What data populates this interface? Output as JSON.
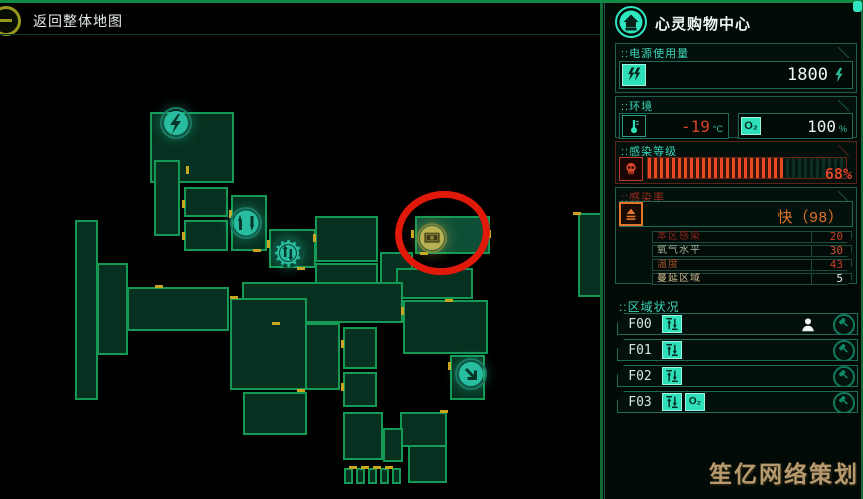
{
  "window": {
    "back_label": "返回整体地图"
  },
  "sidebar": {
    "section_prefix": "::",
    "title": "心灵购物中心",
    "power": {
      "label": "电源使用量",
      "value": "1800"
    },
    "environment": {
      "label": "环境",
      "temperature": "-19",
      "temperature_unit": "°C",
      "oxygen": "100",
      "oxygen_unit": "%"
    },
    "infection_level": {
      "label": "感染等级",
      "percent": 68,
      "percent_label": "68%"
    },
    "infection_rate": {
      "label": "感染率",
      "value": "快（98）",
      "rows": [
        {
          "label": "本区感染",
          "value": "20",
          "label_color": "#8d2317",
          "value_color": "#c63b22",
          "connector_color": "#a02a1a"
        },
        {
          "label": "氧气水平",
          "value": "30",
          "label_color": "#a3b096",
          "value_color": "#d4512a",
          "connector_color": "#c4502a"
        },
        {
          "label": "温度",
          "value": "43",
          "label_color": "#a8562b",
          "value_color": "#c63b22",
          "connector_color": "#b03020"
        },
        {
          "label": "蔓延区域",
          "value": "5",
          "label_color": "#cdb98f",
          "value_color": "#e9efe8",
          "connector_color": "#c8a12c"
        }
      ]
    },
    "area_status": {
      "label": "区域状况",
      "rows": [
        {
          "label": "F00",
          "icons": [
            "elevator"
          ],
          "has_person": true
        },
        {
          "label": "F01",
          "icons": [
            "elevator"
          ],
          "has_person": false
        },
        {
          "label": "F02",
          "icons": [
            "elevator"
          ],
          "has_person": false
        },
        {
          "label": "F03",
          "icons": [
            "elevator",
            "o2"
          ],
          "has_person": false
        }
      ]
    },
    "o2_icon_text": "O₂"
  },
  "map": {
    "rooms": [
      [
        150,
        112,
        84,
        71
      ],
      [
        154,
        160,
        26,
        76
      ],
      [
        184,
        187,
        44,
        30
      ],
      [
        184,
        220,
        44,
        31
      ],
      [
        231,
        195,
        36,
        56
      ],
      [
        269,
        229,
        47,
        39
      ],
      [
        75,
        220,
        23,
        180
      ],
      [
        97,
        263,
        31,
        92
      ],
      [
        127,
        287,
        102,
        44
      ],
      [
        315,
        216,
        63,
        46
      ],
      [
        415,
        216,
        75,
        38,
        1
      ],
      [
        380,
        252,
        33,
        45
      ],
      [
        315,
        263,
        63,
        35
      ],
      [
        396,
        268,
        77,
        31
      ],
      [
        242,
        282,
        161,
        41
      ],
      [
        230,
        298,
        77,
        92
      ],
      [
        403,
        300,
        85,
        54
      ],
      [
        305,
        323,
        35,
        67
      ],
      [
        343,
        327,
        34,
        42
      ],
      [
        343,
        372,
        34,
        35
      ],
      [
        243,
        392,
        64,
        43
      ],
      [
        450,
        355,
        35,
        45
      ],
      [
        343,
        412,
        40,
        48
      ],
      [
        400,
        412,
        47,
        35
      ],
      [
        383,
        428,
        20,
        34
      ],
      [
        408,
        445,
        39,
        38
      ],
      [
        344,
        468,
        9,
        16
      ],
      [
        356,
        468,
        9,
        16
      ],
      [
        368,
        468,
        9,
        16
      ],
      [
        380,
        468,
        9,
        16
      ],
      [
        392,
        468,
        9,
        16
      ],
      [
        578,
        213,
        24,
        84
      ]
    ],
    "doors": [
      [
        186,
        166,
        3,
        8
      ],
      [
        182,
        200,
        3,
        8
      ],
      [
        182,
        232,
        3,
        8
      ],
      [
        229,
        210,
        3,
        8
      ],
      [
        267,
        240,
        3,
        8
      ],
      [
        313,
        234,
        3,
        8
      ],
      [
        411,
        230,
        3,
        8
      ],
      [
        488,
        230,
        3,
        8
      ],
      [
        401,
        307,
        3,
        8
      ],
      [
        448,
        362,
        3,
        8
      ],
      [
        341,
        340,
        3,
        8
      ],
      [
        341,
        383,
        3,
        8
      ],
      [
        253,
        249,
        8,
        3
      ],
      [
        297,
        267,
        8,
        3
      ],
      [
        155,
        285,
        8,
        3
      ],
      [
        230,
        296,
        8,
        3
      ],
      [
        272,
        322,
        8,
        3
      ],
      [
        297,
        389,
        8,
        3
      ],
      [
        420,
        252,
        8,
        3
      ],
      [
        445,
        299,
        8,
        3
      ],
      [
        573,
        212,
        8,
        3
      ],
      [
        349,
        466,
        8,
        3
      ],
      [
        361,
        466,
        8,
        3
      ],
      [
        373,
        466,
        8,
        3
      ],
      [
        385,
        466,
        8,
        3
      ],
      [
        440,
        410,
        8,
        3
      ]
    ],
    "icons": [
      {
        "name": "power-icon",
        "type": "power",
        "x": 176,
        "y": 123
      },
      {
        "name": "elevator-icon",
        "type": "elevator",
        "x": 246,
        "y": 223
      },
      {
        "name": "machine-icon",
        "type": "gear",
        "x": 288,
        "y": 253
      },
      {
        "name": "cash-icon",
        "type": "cash",
        "x": 432,
        "y": 238
      },
      {
        "name": "stairs-down-icon",
        "type": "descend",
        "x": 471,
        "y": 374
      }
    ],
    "annotation": {
      "x": 395,
      "y": 191,
      "w": 95,
      "h": 84,
      "color": "#e0190a",
      "stroke": 7
    }
  },
  "watermark": "笙亿网络策划",
  "colors": {
    "accent": "#2ee6c0",
    "map_green": "#149a55",
    "alert_red": "#e0442a",
    "warn_orange": "#e2762d",
    "door_yellow": "#c9a61f",
    "annotation_red": "#e0190a",
    "watermark_tan": "#b69a6d"
  }
}
